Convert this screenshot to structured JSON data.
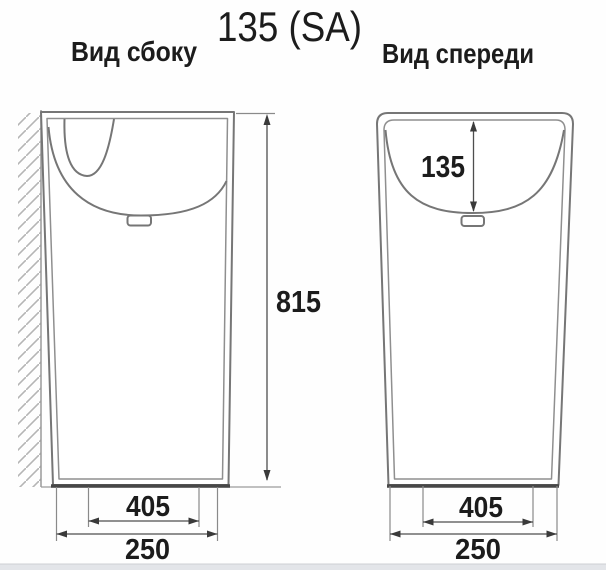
{
  "title": "135 (SA)",
  "views": {
    "side": {
      "label": "Вид сбоку",
      "dims": {
        "height": "815",
        "base_inner_width": "405",
        "base_outer_width": "250"
      }
    },
    "front": {
      "label": "Вид спереди",
      "dims": {
        "basin_depth": "135",
        "base_inner_width": "405",
        "base_outer_width": "250"
      }
    }
  },
  "colors": {
    "outline": "#767676",
    "inner_line": "#8f8f8f",
    "base_edge": "#474747",
    "dimension_line": "#4e4e4e",
    "hatch": "#b5b5b5",
    "text": "#1c1c1c",
    "background": "#fefefe",
    "footer_strip": "#e3e5e9"
  }
}
